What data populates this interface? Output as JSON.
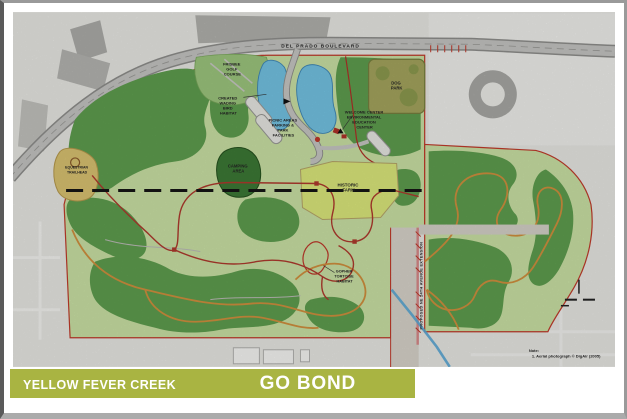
{
  "title_bar": {
    "prefix": "YELLOW FEVER CREEK PRESERVE:",
    "main": "GO BOND PLAN"
  },
  "map": {
    "road_label": "DEL PRADO BOULEVARD",
    "labels": {
      "frisbee_golf": [
        "FRISBEE",
        "GOLF",
        "COURSE"
      ],
      "dog_park": [
        "DOG",
        "PARK"
      ],
      "wading_bird": [
        "CREATED",
        "WADING",
        "BIRD",
        "HABITAT"
      ],
      "picnic": [
        "PICNIC AREAS",
        "PARKING &",
        "PARK",
        "FACILITIES"
      ],
      "welcome_center": [
        "WELCOME CENTER",
        "ENVIRONMENTAL",
        "EDUCATION",
        "CENTER"
      ],
      "camping": [
        "CAMPING",
        "AREA"
      ],
      "historic_farm": [
        "HISTORIC",
        "FARM"
      ],
      "equestrian": [
        "EQUESTRIAN",
        "TRAILHEAD"
      ],
      "gopher": [
        "GOPHER",
        "TORTOISE",
        "HABITAT"
      ],
      "avenue": "PROPOSED NE 24TH AVENUE EXTENSION",
      "note_title": "Note:",
      "note_body": "1. Aerial photograph © DigAir (2005)"
    },
    "colors": {
      "title_olive": "#a9b442",
      "preserve_green": "#cbe3a6",
      "canopy_green": "#5f9e4f",
      "pond_blue": "#74c4e4",
      "boundary_red": "#c23b2b",
      "trail_red": "#b03a2e",
      "trail_orange": "#d2913f",
      "historic_farm_yellow": "#dde97c",
      "dog_park_olive": "#a5a65e"
    }
  }
}
